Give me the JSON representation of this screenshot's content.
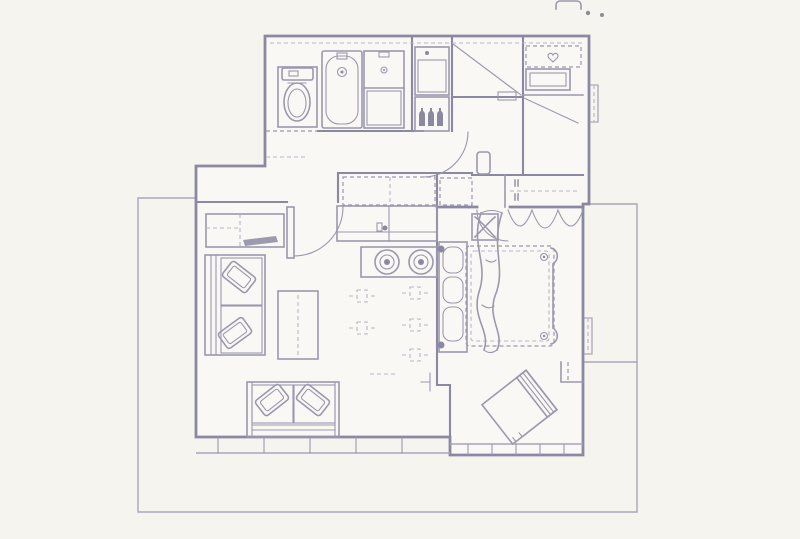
{
  "colors": {
    "bg": "#f6f4ef",
    "floor": "#faf8f4",
    "wall": "#8b89a1",
    "line": "#9a98ae",
    "faint": "#b6b4c7",
    "dot": "#8f8a99"
  },
  "floorplan": {
    "type": "apartment-floor-plan",
    "rooms": [
      "bathroom",
      "hallway",
      "wardrobe-room",
      "entry",
      "kitchen",
      "living-room",
      "bedroom",
      "terrace",
      "balcony"
    ],
    "fixtures": [
      "toilet",
      "bathtub",
      "sink-cabinet",
      "bottle-shelf",
      "hall-closet",
      "sliding-wardrobe",
      "shelf-unit",
      "kitchen-counter",
      "upper-cabinets",
      "stove-two-burner",
      "sideboard-with-tv",
      "sofa-left",
      "sofa-bottom",
      "throw-pillows",
      "coffee-table",
      "dining-layout-marks",
      "bed-double",
      "duvet",
      "bed-wardrobe-shelves",
      "bedside-stool",
      "hanging-clothes",
      "armchair",
      "window-bands",
      "door-swings"
    ]
  },
  "artifacts": {
    "top_edge_tab": 1,
    "top_edge_dots": 2
  }
}
